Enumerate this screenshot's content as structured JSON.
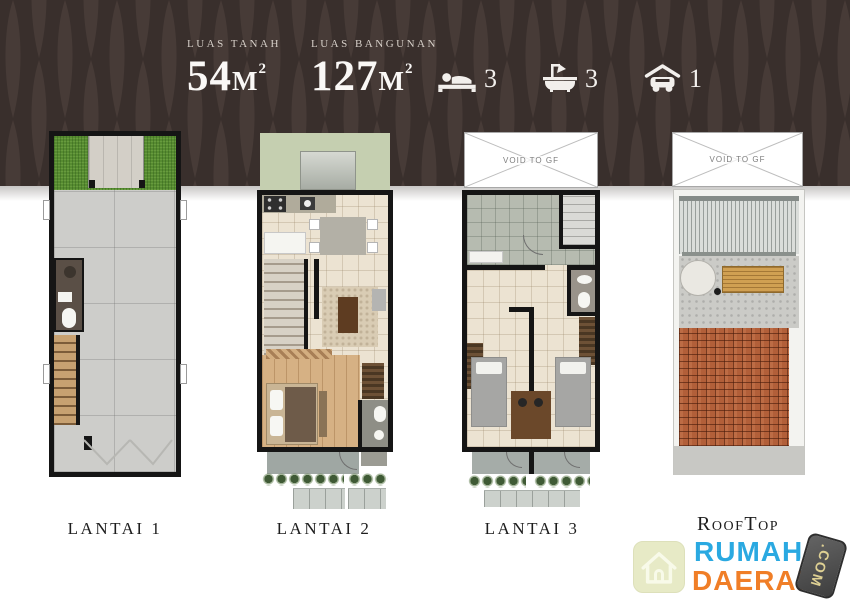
{
  "header": {
    "land": {
      "label": "LUAS TANAH",
      "value": "54",
      "unit": "M",
      "superscript": "2"
    },
    "building": {
      "label": "LUAS BANGUNAN",
      "value": "127",
      "unit": "M",
      "superscript": "2"
    },
    "features": [
      {
        "name": "bedrooms",
        "icon": "bed-icon",
        "count": "3"
      },
      {
        "name": "bathrooms",
        "icon": "bath-icon",
        "count": "3"
      },
      {
        "name": "garage",
        "icon": "car-icon",
        "count": "1"
      }
    ]
  },
  "plans": [
    {
      "id": "lantai-1",
      "label": "LANTAI 1"
    },
    {
      "id": "lantai-2",
      "label": "LANTAI 2"
    },
    {
      "id": "lantai-3",
      "label": "LANTAI 3",
      "void_label": "VOID TO GF"
    },
    {
      "id": "rooftop",
      "label": "RoofTop",
      "void_label": "VOID TO GF"
    }
  ],
  "watermark": {
    "icon": "house-icon",
    "line1": "RUMAH",
    "line2": "DAERAH",
    "suffix": ".COM"
  },
  "palette": {
    "header_bg": "#392f2c",
    "header_leaf": "#473b37",
    "text_light": "#f2efec",
    "wall": "#151515",
    "grass": "#578c31",
    "cream_floor": "#ece3d2",
    "wood_floor": "#d6b184",
    "concrete": "#cdcdca",
    "brick": "#b25f39",
    "logo_blue": "#2aa9e1",
    "logo_orange": "#f07e27",
    "logo_badge_text": "#ded093"
  }
}
